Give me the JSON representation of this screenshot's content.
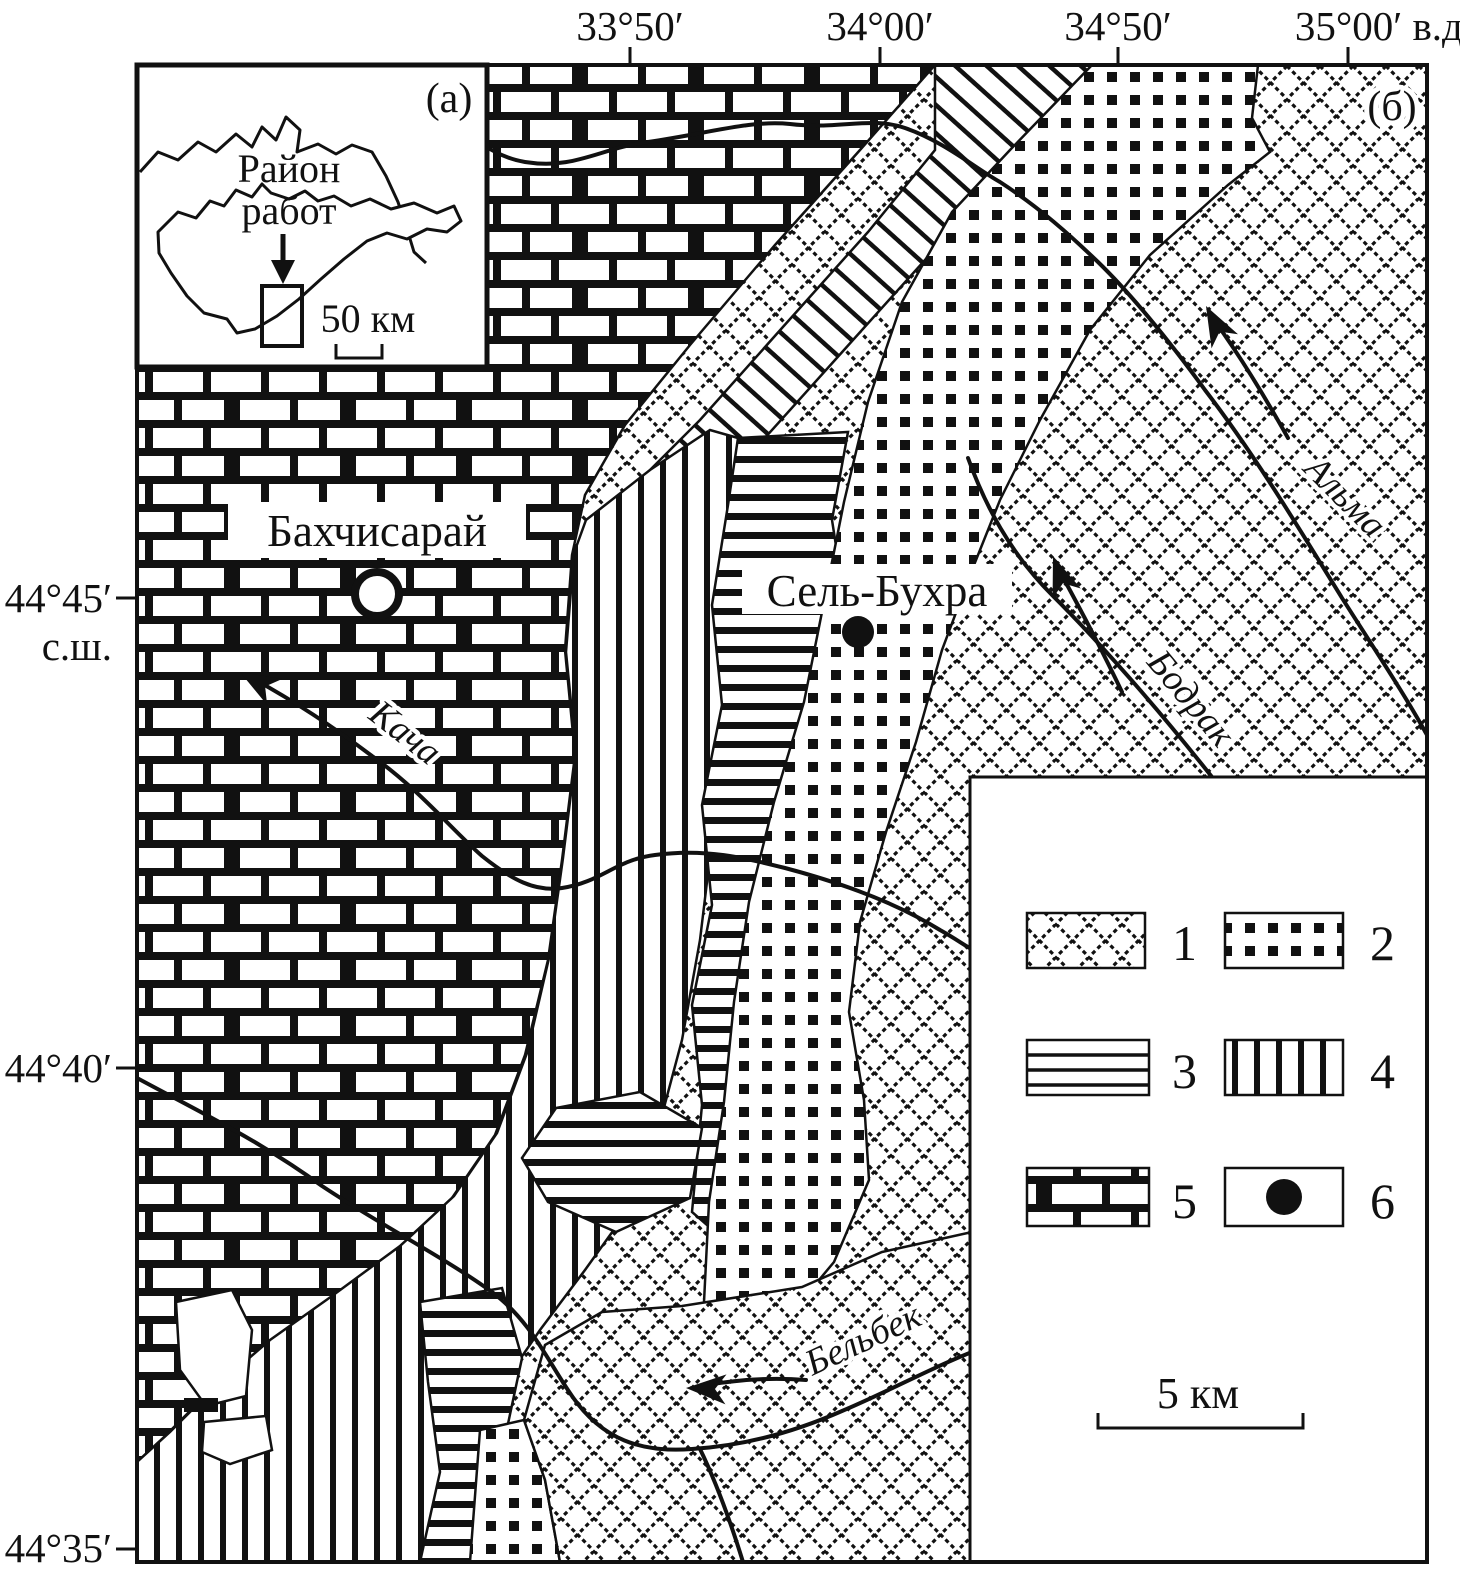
{
  "colors": {
    "ink": "#111111",
    "paper": "#ffffff"
  },
  "axis": {
    "top_ticks": [
      "33°50′",
      "34°00′",
      "34°50′",
      "35°00′ в.д."
    ],
    "left_ticks": [
      "44°45′",
      "с.ш.",
      "44°40′",
      "44°35′"
    ]
  },
  "inset": {
    "panel_label": "(а)",
    "callout_line1": "Район",
    "callout_line2": "работ",
    "scale_label": "50 км"
  },
  "map": {
    "panel_label": "(б)",
    "cities": [
      {
        "name": "Бахчисарай",
        "marker": "open-circle"
      },
      {
        "name": "Сель-Бухра",
        "marker": "filled-circle"
      }
    ],
    "rivers": [
      {
        "name": "Кача"
      },
      {
        "name": "Альма"
      },
      {
        "name": "Бодрак"
      },
      {
        "name": "Бельбек"
      }
    ]
  },
  "legend": {
    "items": [
      {
        "label": "1",
        "pattern": "diamond-crosshatch"
      },
      {
        "label": "2",
        "pattern": "dotted"
      },
      {
        "label": "3",
        "pattern": "horizontal-lines"
      },
      {
        "label": "4",
        "pattern": "vertical-bars"
      },
      {
        "label": "5",
        "pattern": "brick"
      },
      {
        "label": "6",
        "pattern": "filled-circle"
      }
    ],
    "scale_label": "5 км"
  }
}
